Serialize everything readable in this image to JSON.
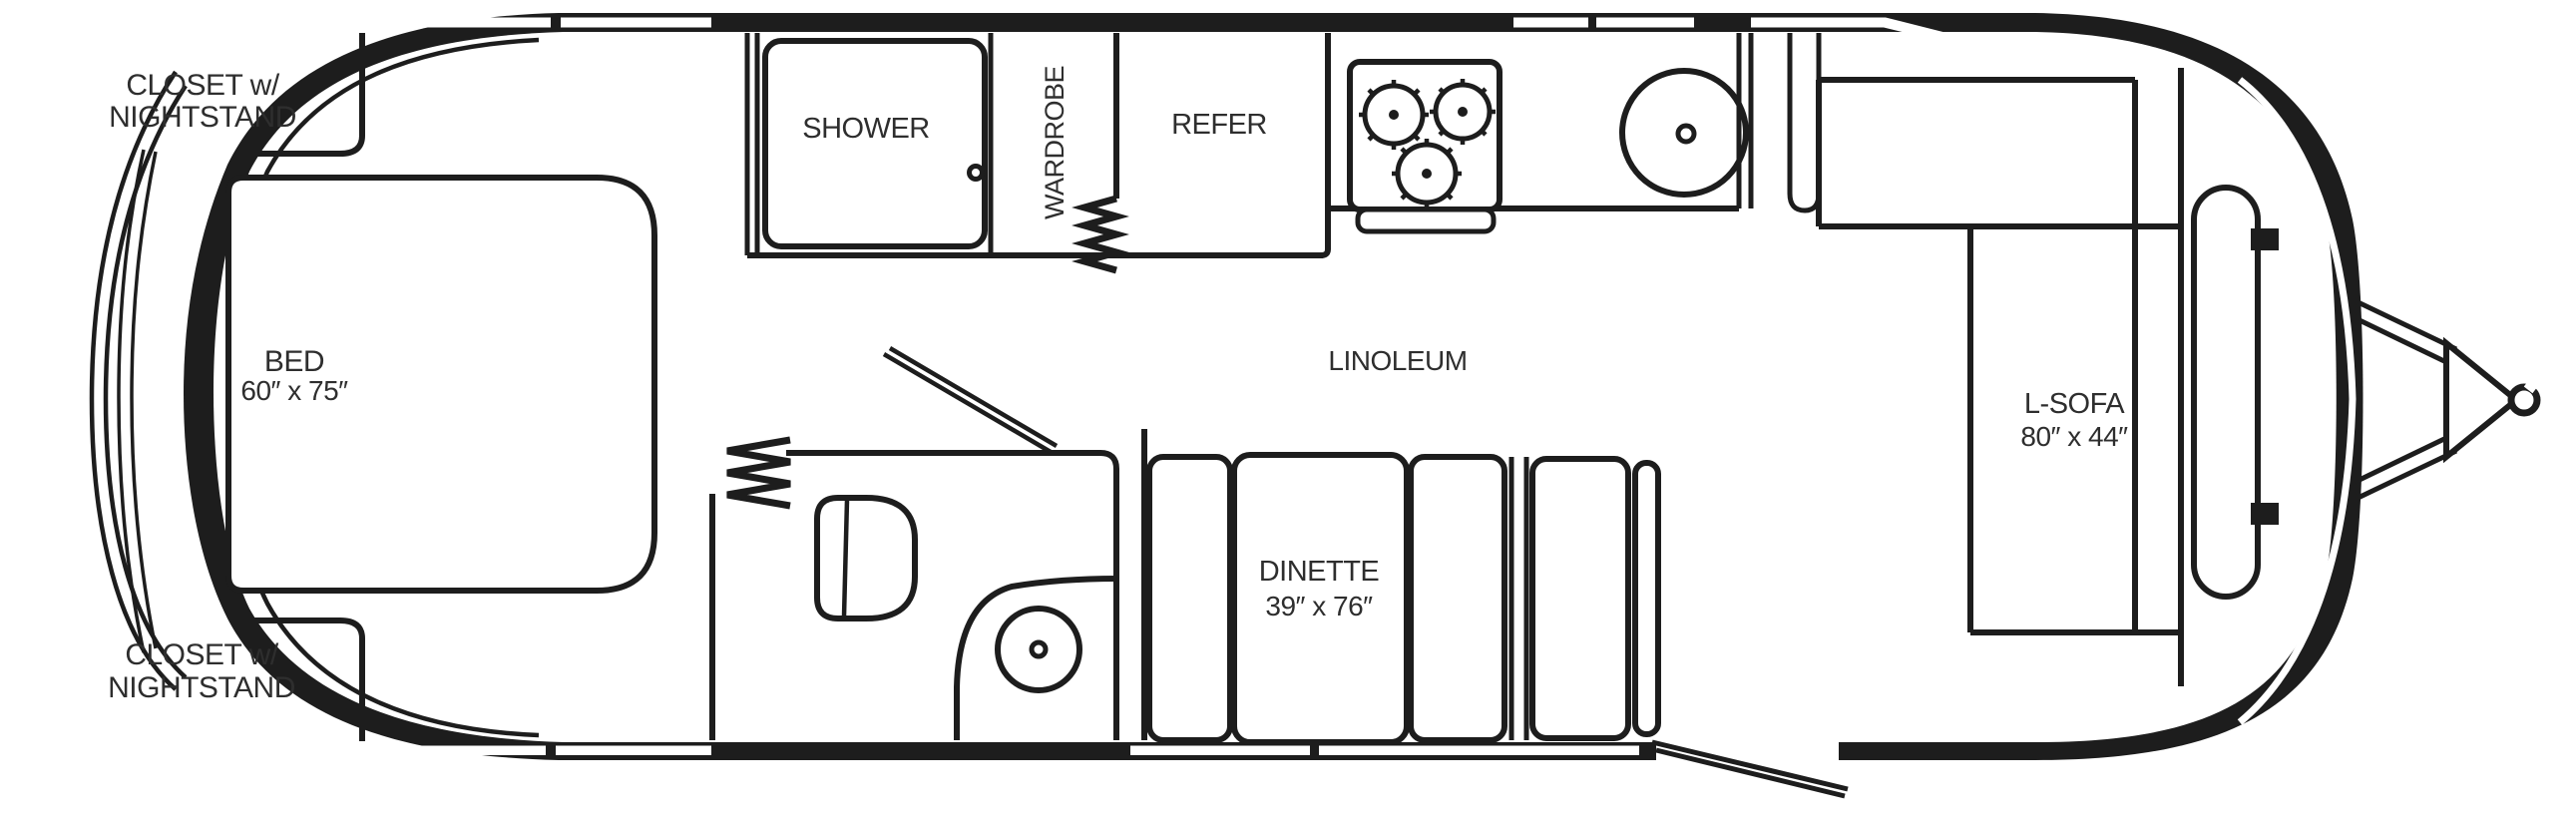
{
  "diagram": {
    "type": "travel-trailer-floor-plan",
    "colors": {
      "line": "#1d1d1d",
      "background": "#ffffff",
      "text": "#2e2e2e"
    },
    "labels": {
      "closet_top": {
        "line1": "CLOSET w/",
        "line2": "NIGHTSTAND"
      },
      "closet_bottom": {
        "line1": "CLOSET w/",
        "line2": "NIGHTSTAND"
      },
      "bed": {
        "name": "BED",
        "dims": "60″ x 75″"
      },
      "shower": "SHOWER",
      "wardrobe": "WARDROBE",
      "refer": "REFER",
      "linoleum": "LINOLEUM",
      "dinette": {
        "name": "DINETTE",
        "dims": "39″ x 76″"
      },
      "l_sofa": {
        "name": "L-SOFA",
        "dims": "80″ x 44″"
      }
    }
  }
}
